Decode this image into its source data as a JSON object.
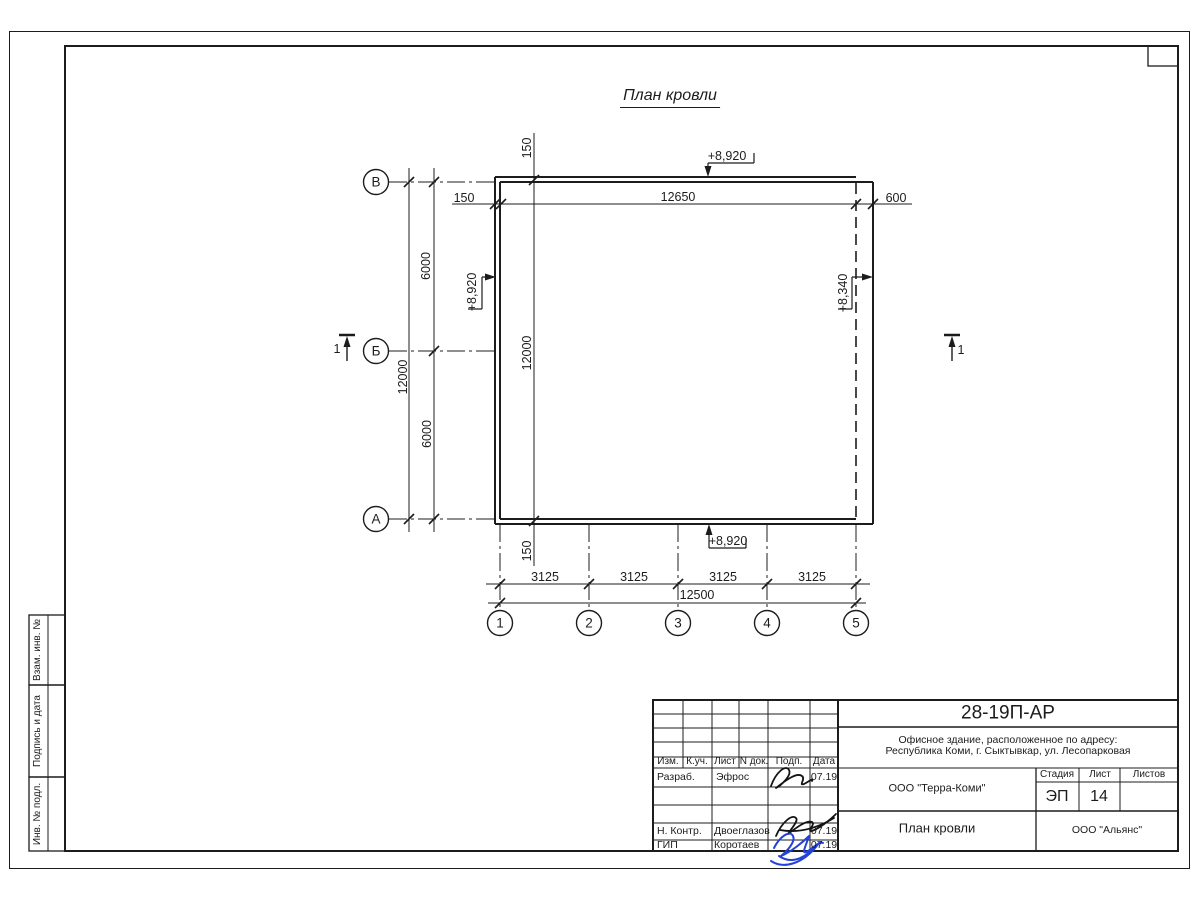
{
  "drawing": {
    "title": "План кровли",
    "row_axes": [
      "В",
      "Б",
      "А"
    ],
    "col_axes": [
      "1",
      "2",
      "3",
      "4",
      "5"
    ],
    "section_mark": "1",
    "dims": {
      "offset_left": "150",
      "top_span": "12650",
      "right_overhang": "600",
      "left_total": "12000",
      "left_upper": "6000",
      "left_lower": "6000",
      "offset_top": "150",
      "wall_span": "12000",
      "offset_bottom": "150",
      "bottom_spans": [
        "3125",
        "3125",
        "3125",
        "3125"
      ],
      "bottom_total": "12500"
    },
    "levels": {
      "top": "+8,920",
      "left": "+8,920",
      "right": "+8,340",
      "bottom": "+8,920"
    }
  },
  "side_columns": [
    "Взам. инв. №",
    "Подпись и дата",
    "Инв. № подл."
  ],
  "title_block": {
    "doc_number": "28-19П-АР",
    "project_line1": "Офисное здание, расположенное по адресу:",
    "project_line2": "Республика Коми, г. Сыктывкар, ул. Лесопарковая",
    "revision_headers": [
      "Изм.",
      "К.уч.",
      "Лист",
      "N док.",
      "Подп.",
      "Дата"
    ],
    "rows": [
      {
        "role": "Разраб.",
        "name": "Эфрос",
        "date": "07.19"
      },
      {
        "role": "Н. Контр.",
        "name": "Двоеглазов",
        "date": "07.19"
      },
      {
        "role": "ГИП",
        "name": "Коротаев",
        "date": "07.19"
      }
    ],
    "company": "ООО \"Терра-Коми\"",
    "stage_header": "Стадия",
    "sheet_header": "Лист",
    "sheets_header": "Листов",
    "stage": "ЭП",
    "sheet_number": "14",
    "sheets_total": "",
    "drawing_title": "План кровли",
    "contractor": "ООО \"Альянс\""
  }
}
